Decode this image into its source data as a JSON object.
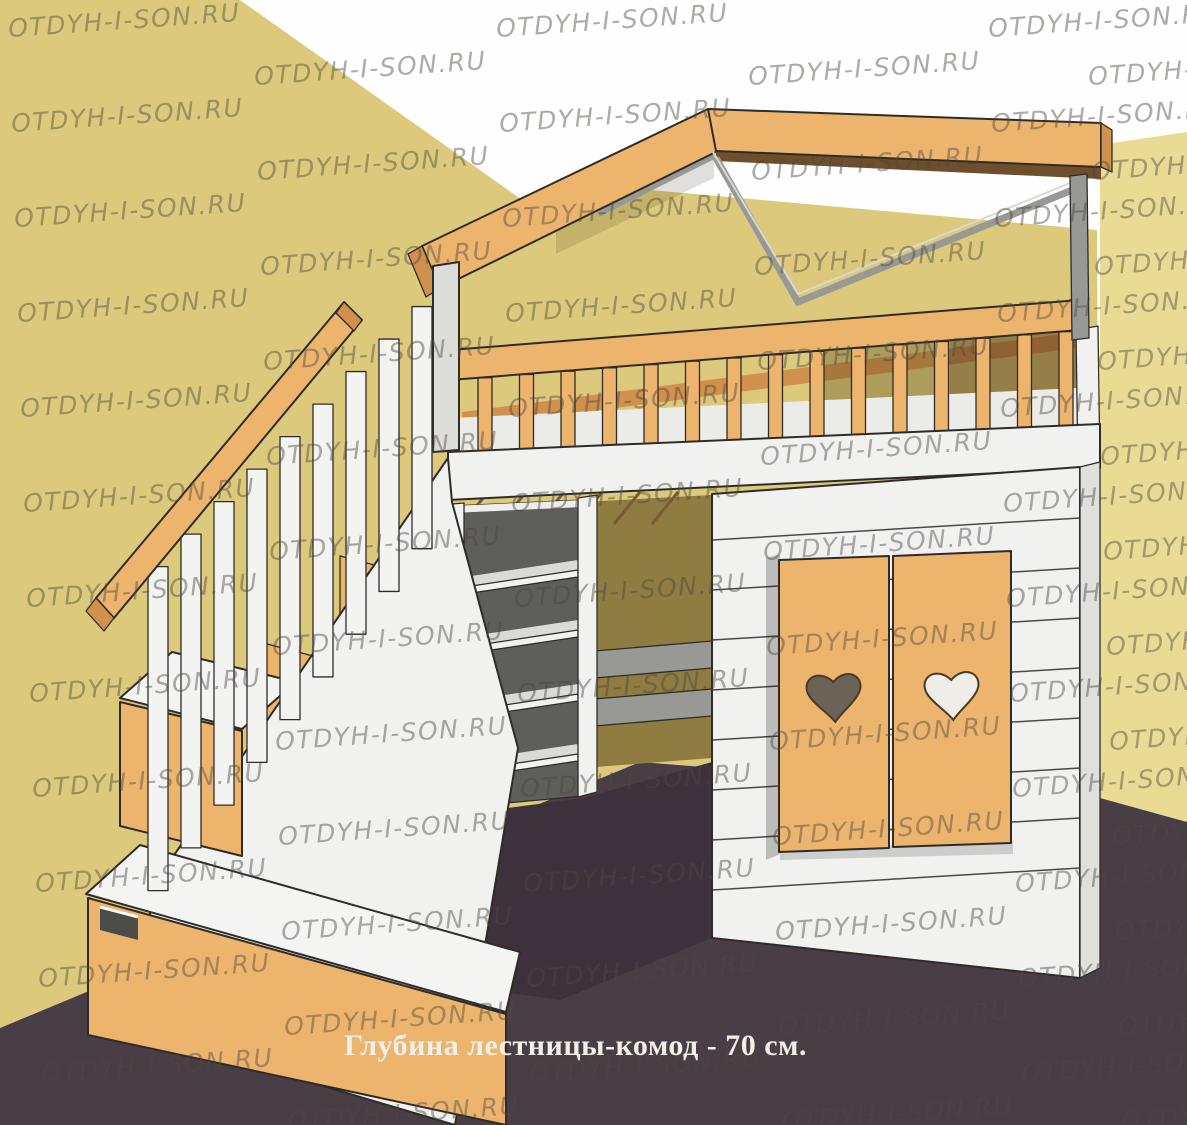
{
  "scene": {
    "caption": "Глубина лестницы-комод - 70 см.",
    "watermark": "OTDYH-I-SON.RU"
  },
  "palette": {
    "wall_left": "#dcc97b",
    "wall_right": "#e9da94",
    "floor": "#4a3e46",
    "floor_dark": "#3d323b",
    "wood": "#ecb46d",
    "wood_dark": "#d1914e",
    "underside": "#6f4e2c",
    "white_wood": "#f1f1ef",
    "white_shade": "#dfdfdc",
    "gray": "#989894",
    "olive": "#8e7c41",
    "outline": "#2f2c27",
    "watermark_color": "rgba(75,72,64,0.45)",
    "caption_color": "#f2efe8"
  }
}
